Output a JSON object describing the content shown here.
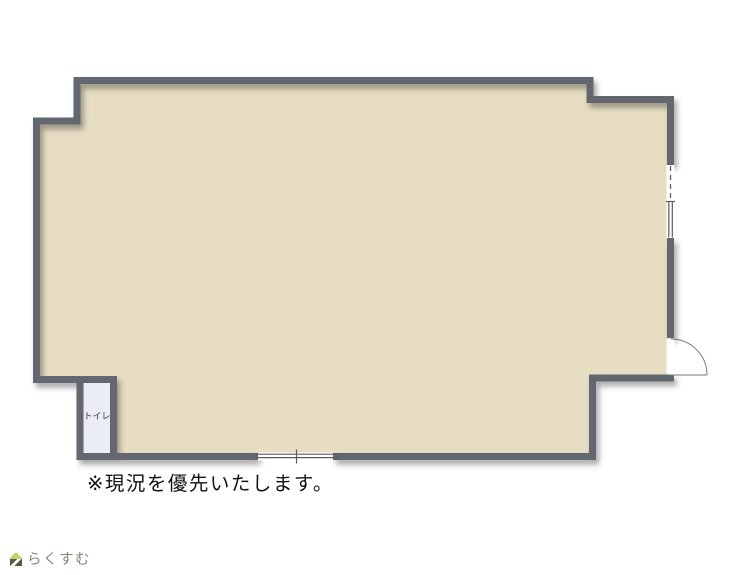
{
  "floorplan": {
    "toilet_label": "トイレ",
    "caption": "※現況を優先いたします。"
  },
  "footer": {
    "logo_text": "らくすむ"
  },
  "colors": {
    "floor": "#e7ddc3",
    "wall": "#646770",
    "toilet-floor": "#ececf4",
    "symbol-line": "#5a5b63",
    "door-line": "#77787e",
    "caption-text": "#111111",
    "logo-text": "#8d8277",
    "logo-roof": "#c2d35e",
    "logo-body": "#59544c"
  }
}
